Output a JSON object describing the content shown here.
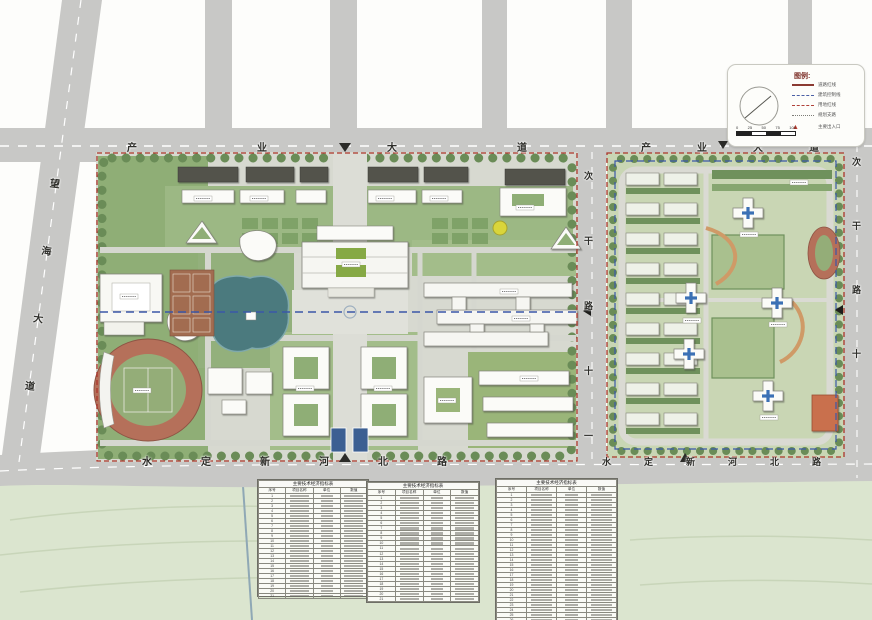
{
  "roads": {
    "industry_avenue": "产业大道",
    "wanghai_avenue": "望海大道",
    "shuiding_xinhe_north_road": "水定新河北路",
    "middle_secondary_road": "次干路十一",
    "east_secondary_road": "次干路十"
  },
  "legend": {
    "title": "图例:",
    "items": [
      {
        "label": "道路红线",
        "style": "solid-red"
      },
      {
        "label": "建筑控制线",
        "style": "dashed-blue"
      },
      {
        "label": "用地红线",
        "style": "dashed-red"
      },
      {
        "label": "规划支路",
        "style": "dotted-gray"
      },
      {
        "label": "主要出入口",
        "style": "triangle"
      }
    ],
    "scale_ticks": [
      "0",
      "25",
      "50",
      "75",
      "100"
    ]
  },
  "tables": [
    {
      "title": "主要技术经济指标表",
      "headers": [
        "序号",
        "项目名称",
        "单位",
        "数值"
      ],
      "row_count": 21
    },
    {
      "title": "主要技术经济指标表",
      "headers": [
        "序号",
        "项目名称",
        "单位",
        "数值"
      ],
      "row_count": 21
    },
    {
      "title": "主要技术经济指标表",
      "headers": [
        "序号",
        "项目名称",
        "单位",
        "数值"
      ],
      "row_count": 26
    }
  ],
  "colors": {
    "boundary_red": "#ab352b",
    "control_blue": "#3a57a8",
    "road_gray": "#c8c8c6",
    "water": "#4b7a7e",
    "track": "#b5705a",
    "lawn": "#9db884",
    "accent_cross": "#3a6fb5"
  }
}
